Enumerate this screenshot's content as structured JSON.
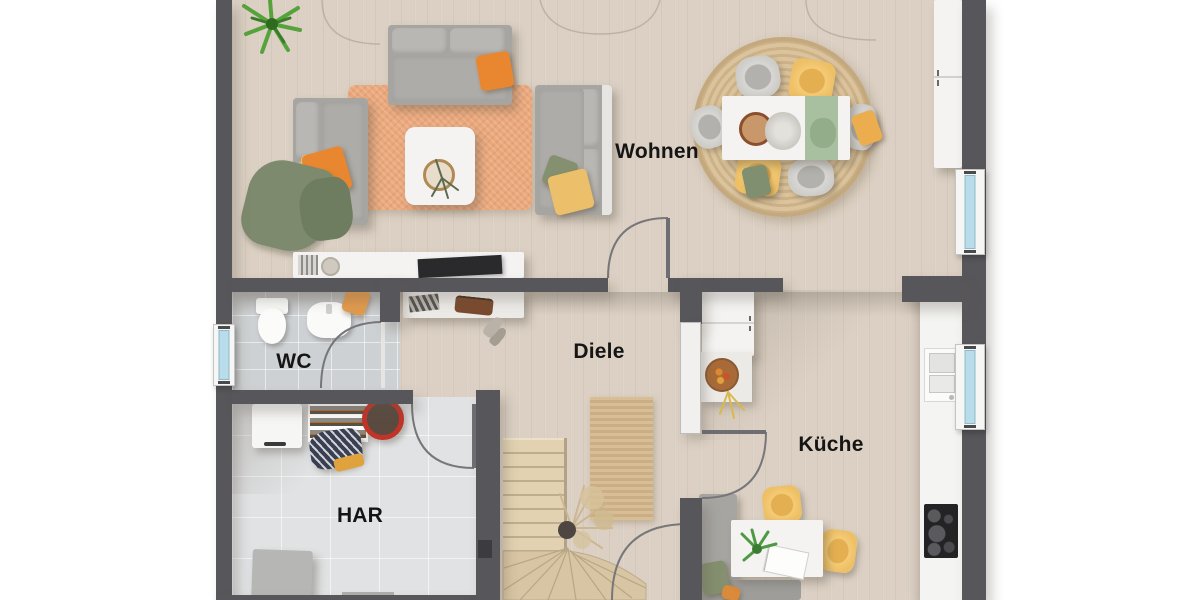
{
  "plan": {
    "rooms": {
      "wohnen": {
        "label": "Wohnen"
      },
      "diele": {
        "label": "Diele"
      },
      "wc": {
        "label": "WC"
      },
      "har": {
        "label": "HAR"
      },
      "kueche": {
        "label": "Küche"
      }
    },
    "colors": {
      "wall": "#57565a",
      "wood_floor": "#dbd0c3",
      "tile_wc": "#ced1d3",
      "tile_har": "#e0e2e3",
      "rug_orange": "#eaa87c",
      "rug_jute": "#d2b992",
      "accent_orange": "#e8872f",
      "accent_yellow": "#efc266",
      "accent_green": "#7d8a6d",
      "window_glass": "#b9dcea",
      "stairs_wood": "#d8c5a3",
      "letterbox": "#ffffff"
    }
  }
}
